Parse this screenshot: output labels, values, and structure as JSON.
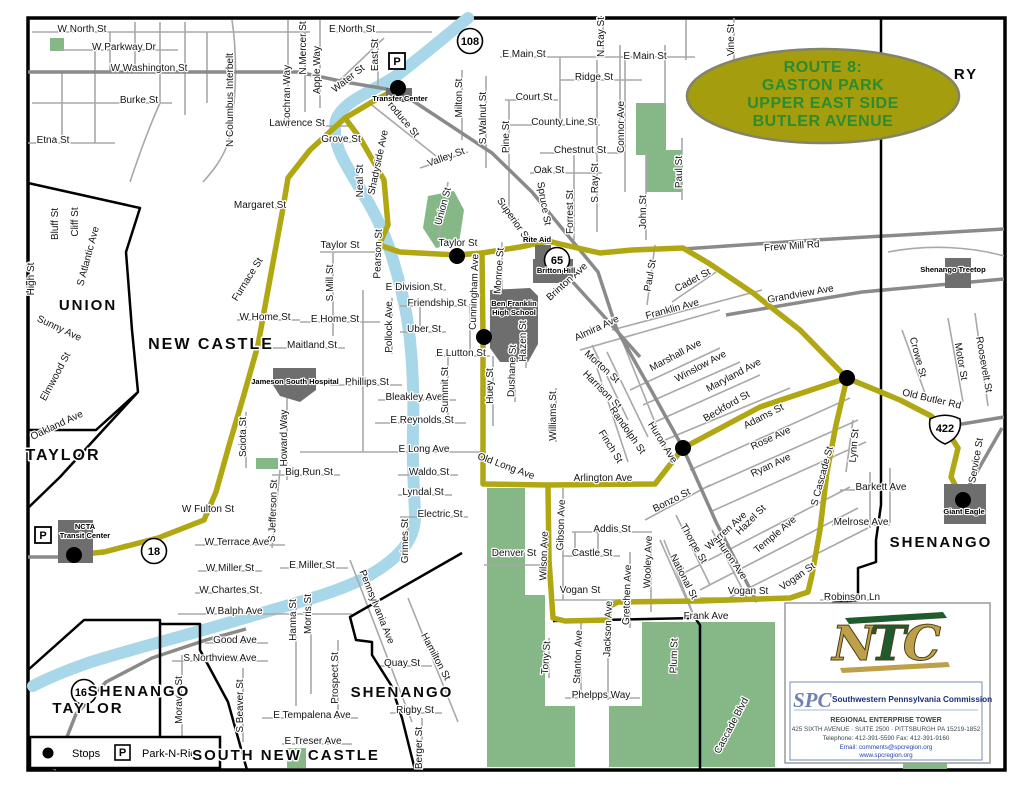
{
  "title_oval": {
    "lines": [
      "ROUTE 8:",
      "GASTON PARK",
      "UPPER EAST SIDE",
      "BUTLER AVENUE"
    ],
    "bg_color": "#a49d0e",
    "text_color": "#2e8b2e"
  },
  "legend": {
    "stops_label": "Stops",
    "park_symbol": "P",
    "park_n_ride_label": "Park-N-Ride"
  },
  "logo_box": {
    "ntc": "NTC",
    "spc": "SPC",
    "org": "Southwestern Pennsylvania Commission",
    "lines": [
      "REGIONAL ENTERPRISE TOWER",
      "425 SIXTH AVENUE · SUITE 2500 · PITTSBURGH PA 15219-1852",
      "Telephone:  412-391-5590        Fax:  412-391-9160",
      "Email: comments@spcregion.org",
      "www.spcregion.org"
    ]
  },
  "map": {
    "colors": {
      "route": "#b1a712",
      "river": "#a7d7e8",
      "park": "#86b786",
      "landmark": "#6e6e6e",
      "artery": "#8a8a8a",
      "street": "#a8a8a8",
      "boundary": "#000000"
    },
    "stops": [
      {
        "x": 398,
        "y": 88
      },
      {
        "x": 457,
        "y": 256
      },
      {
        "x": 484,
        "y": 337
      },
      {
        "x": 683,
        "y": 448
      },
      {
        "x": 847,
        "y": 378
      },
      {
        "x": 963,
        "y": 500
      },
      {
        "x": 74,
        "y": 555
      }
    ],
    "park_and_ride_icons": [
      {
        "x": 397,
        "y": 61
      },
      {
        "x": 43,
        "y": 535
      }
    ],
    "highway_shields": [
      {
        "n": "108",
        "x": 470,
        "y": 41,
        "type": "circle"
      },
      {
        "n": "65",
        "x": 557,
        "y": 260,
        "type": "circle"
      },
      {
        "n": "18",
        "x": 154,
        "y": 551,
        "type": "circle"
      },
      {
        "n": "168",
        "x": 84,
        "y": 692,
        "type": "circle"
      },
      {
        "n": "422",
        "x": 945,
        "y": 428,
        "type": "us"
      }
    ],
    "landmark_labels": [
      {
        "t": "Transfer Center",
        "x": 400,
        "y": 101
      },
      {
        "t": "Rite Aid",
        "x": 537,
        "y": 242
      },
      {
        "t": "Britton Hill",
        "x": 556,
        "y": 273
      },
      {
        "t": "Ben Franklin",
        "x": 514,
        "y": 306
      },
      {
        "t": "High School",
        "x": 514,
        "y": 315
      },
      {
        "t": "Jameson South Hospital",
        "x": 295,
        "y": 384
      },
      {
        "t": "NCTA",
        "x": 85,
        "y": 529
      },
      {
        "t": "Transit Center",
        "x": 85,
        "y": 538
      },
      {
        "t": "Shenango Treetop",
        "x": 953,
        "y": 272
      },
      {
        "t": "Giant Eagle",
        "x": 964,
        "y": 514
      }
    ],
    "area_labels": [
      {
        "t": "UNION",
        "x": 88,
        "y": 310,
        "fs": 15
      },
      {
        "t": "NEW CASTLE",
        "x": 211,
        "y": 349,
        "fs": 16
      },
      {
        "t": "TAYLOR",
        "x": 63,
        "y": 460,
        "fs": 16
      },
      {
        "t": "TAYLOR",
        "x": 88,
        "y": 713,
        "fs": 15
      },
      {
        "t": "SHENANGO",
        "x": 139,
        "y": 696,
        "fs": 15
      },
      {
        "t": "SHENANGO",
        "x": 402,
        "y": 697,
        "fs": 15
      },
      {
        "t": "SHENANGO",
        "x": 941,
        "y": 547,
        "fs": 15
      },
      {
        "t": "SOUTH NEW CASTLE",
        "x": 286,
        "y": 760,
        "fs": 15
      },
      {
        "t": "RY",
        "x": 966,
        "y": 79,
        "fs": 15
      }
    ],
    "street_labels": [
      {
        "t": "W North St",
        "x": 82,
        "y": 32
      },
      {
        "t": "W Parkway Dr",
        "x": 124,
        "y": 50
      },
      {
        "t": "W Washington St",
        "x": 149,
        "y": 71
      },
      {
        "t": "Burke St",
        "x": 139,
        "y": 103
      },
      {
        "t": "Etna St",
        "x": 53,
        "y": 143
      },
      {
        "t": "N Columbus Interbelt",
        "x": 233,
        "y": 100,
        "r": -90
      },
      {
        "t": "Cochran Way",
        "x": 290,
        "y": 95,
        "r": -90
      },
      {
        "t": "N Mercer St",
        "x": 306,
        "y": 48,
        "r": -90
      },
      {
        "t": "Apple Way",
        "x": 320,
        "y": 70,
        "r": -90
      },
      {
        "t": "E North St",
        "x": 352,
        "y": 32
      },
      {
        "t": "East St",
        "x": 378,
        "y": 55,
        "r": -90
      },
      {
        "t": "Water St",
        "x": 350,
        "y": 81,
        "r": -38
      },
      {
        "t": "Produce St",
        "x": 399,
        "y": 119,
        "r": 50
      },
      {
        "t": "Lawrence St",
        "x": 297,
        "y": 126
      },
      {
        "t": "Grove St",
        "x": 341,
        "y": 142
      },
      {
        "t": "Neal St",
        "x": 363,
        "y": 181,
        "r": -90
      },
      {
        "t": "Shadyside Ave",
        "x": 381,
        "y": 163,
        "r": -78
      },
      {
        "t": "Milton St",
        "x": 462,
        "y": 98,
        "r": -90
      },
      {
        "t": "S Walnut St",
        "x": 486,
        "y": 118,
        "r": -90
      },
      {
        "t": "Pine St",
        "x": 509,
        "y": 137,
        "r": -90
      },
      {
        "t": "Valley St",
        "x": 447,
        "y": 160,
        "r": -20
      },
      {
        "t": "Union St",
        "x": 446,
        "y": 207,
        "r": -75
      },
      {
        "t": "Superior St",
        "x": 511,
        "y": 221,
        "r": 55
      },
      {
        "t": "Spruce St",
        "x": 541,
        "y": 204,
        "r": 80
      },
      {
        "t": "Forrest St",
        "x": 573,
        "y": 212,
        "r": -90
      },
      {
        "t": "S Ray St",
        "x": 598,
        "y": 183,
        "r": -90
      },
      {
        "t": "John St",
        "x": 646,
        "y": 212,
        "r": -90
      },
      {
        "t": "Paul St",
        "x": 682,
        "y": 172,
        "r": -90
      },
      {
        "t": "Paul St",
        "x": 653,
        "y": 276,
        "r": -80
      },
      {
        "t": "Cadet St",
        "x": 694,
        "y": 283,
        "r": -28
      },
      {
        "t": "Frew Mill Rd",
        "x": 792,
        "y": 249,
        "r": -4
      },
      {
        "t": "Grandview Ave",
        "x": 801,
        "y": 297,
        "r": -10
      },
      {
        "t": "Crowe St",
        "x": 915,
        "y": 358,
        "r": 75
      },
      {
        "t": "Motor St",
        "x": 958,
        "y": 362,
        "r": 80
      },
      {
        "t": "Roosevelt St",
        "x": 981,
        "y": 365,
        "r": 80
      },
      {
        "t": "Old Butler Rd",
        "x": 931,
        "y": 402,
        "r": 13
      },
      {
        "t": "Service St",
        "x": 979,
        "y": 461,
        "r": -80
      },
      {
        "t": "E Main St",
        "x": 524,
        "y": 57
      },
      {
        "t": "E Main St",
        "x": 645,
        "y": 59
      },
      {
        "t": "Ridge St",
        "x": 594,
        "y": 80
      },
      {
        "t": "Court St",
        "x": 534,
        "y": 100
      },
      {
        "t": "County Line St",
        "x": 564,
        "y": 125
      },
      {
        "t": "Chestnut St",
        "x": 580,
        "y": 153
      },
      {
        "t": "Oak St",
        "x": 549,
        "y": 173
      },
      {
        "t": "N Ray St",
        "x": 604,
        "y": 37,
        "r": -90
      },
      {
        "t": "Vine St",
        "x": 734,
        "y": 40,
        "r": -90
      },
      {
        "t": "Connor Ave",
        "x": 624,
        "y": 127,
        "r": -90
      },
      {
        "t": "Margaret St",
        "x": 260,
        "y": 208
      },
      {
        "t": "Furnace St",
        "x": 250,
        "y": 281,
        "r": -58
      },
      {
        "t": "W Home St",
        "x": 265,
        "y": 320
      },
      {
        "t": "E Home St",
        "x": 335,
        "y": 322
      },
      {
        "t": "Maitland St",
        "x": 312,
        "y": 348
      },
      {
        "t": "Phillips St",
        "x": 367,
        "y": 385
      },
      {
        "t": "Bleakley Ave",
        "x": 414,
        "y": 400
      },
      {
        "t": "E Reynolds St",
        "x": 422,
        "y": 423
      },
      {
        "t": "E Long Ave",
        "x": 424,
        "y": 452
      },
      {
        "t": "Big Run St",
        "x": 309,
        "y": 475
      },
      {
        "t": "Waldo St",
        "x": 429,
        "y": 475
      },
      {
        "t": "Lyndal St",
        "x": 423,
        "y": 495
      },
      {
        "t": "Electric St",
        "x": 440,
        "y": 517
      },
      {
        "t": "Grimes St",
        "x": 408,
        "y": 541,
        "r": -90
      },
      {
        "t": "Sciota St",
        "x": 246,
        "y": 437,
        "r": -90
      },
      {
        "t": "Howard Way",
        "x": 287,
        "y": 438,
        "r": -90
      },
      {
        "t": "S Jefferson St",
        "x": 276,
        "y": 511,
        "r": -88
      },
      {
        "t": "Taylor St",
        "x": 340,
        "y": 248
      },
      {
        "t": "Taylor St",
        "x": 458,
        "y": 246
      },
      {
        "t": "Pearson St",
        "x": 381,
        "y": 254,
        "r": -88
      },
      {
        "t": "S Mill St",
        "x": 333,
        "y": 283,
        "r": -90
      },
      {
        "t": "Pollock Ave",
        "x": 392,
        "y": 327,
        "r": -90
      },
      {
        "t": "E Division St",
        "x": 414,
        "y": 290
      },
      {
        "t": "Friendship St",
        "x": 437,
        "y": 306
      },
      {
        "t": "Uber St",
        "x": 424,
        "y": 332
      },
      {
        "t": "E Lutton St",
        "x": 461,
        "y": 356
      },
      {
        "t": "Cunningham Ave",
        "x": 477,
        "y": 292,
        "r": -88
      },
      {
        "t": "Monroe St",
        "x": 502,
        "y": 271,
        "r": -86
      },
      {
        "t": "Hazen St",
        "x": 526,
        "y": 341,
        "r": -90
      },
      {
        "t": "Dushane St",
        "x": 515,
        "y": 371,
        "r": -88
      },
      {
        "t": "Huey St",
        "x": 493,
        "y": 386,
        "r": -90
      },
      {
        "t": "Williams St",
        "x": 556,
        "y": 416,
        "r": -90
      },
      {
        "t": "Summit St",
        "x": 448,
        "y": 390,
        "r": -90
      },
      {
        "t": "Brinton Ave",
        "x": 569,
        "y": 284,
        "r": -42
      },
      {
        "t": "Almira Ave",
        "x": 598,
        "y": 331,
        "r": -25
      },
      {
        "t": "Franklin Ave",
        "x": 673,
        "y": 312,
        "r": -15
      },
      {
        "t": "Morton St",
        "x": 600,
        "y": 369,
        "r": 42
      },
      {
        "t": "Harrison St",
        "x": 600,
        "y": 392,
        "r": 45
      },
      {
        "t": "Marshall Ave",
        "x": 677,
        "y": 358,
        "r": -28
      },
      {
        "t": "Winslow Ave",
        "x": 702,
        "y": 369,
        "r": -28
      },
      {
        "t": "Maryland Ave",
        "x": 735,
        "y": 378,
        "r": -28
      },
      {
        "t": "Beckford St",
        "x": 728,
        "y": 409,
        "r": -30
      },
      {
        "t": "Adams St",
        "x": 765,
        "y": 419,
        "r": -27
      },
      {
        "t": "Rose Ave",
        "x": 772,
        "y": 441,
        "r": -25
      },
      {
        "t": "Ryan Ave",
        "x": 772,
        "y": 468,
        "r": -25
      },
      {
        "t": "Randolph St",
        "x": 625,
        "y": 432,
        "r": 55
      },
      {
        "t": "Finch St",
        "x": 608,
        "y": 448,
        "r": 58
      },
      {
        "t": "Huron Ave",
        "x": 660,
        "y": 444,
        "r": 58
      },
      {
        "t": "Bonzo St",
        "x": 673,
        "y": 503,
        "r": -27
      },
      {
        "t": "Old Long Ave",
        "x": 505,
        "y": 469,
        "r": 20
      },
      {
        "t": "Arlington Ave",
        "x": 603,
        "y": 481
      },
      {
        "t": "Addis St",
        "x": 612,
        "y": 532
      },
      {
        "t": "Castle St",
        "x": 592,
        "y": 556
      },
      {
        "t": "Denver St",
        "x": 514,
        "y": 556
      },
      {
        "t": "Wilson Ave",
        "x": 547,
        "y": 556,
        "r": -88
      },
      {
        "t": "Gibson Ave",
        "x": 564,
        "y": 525,
        "r": -88
      },
      {
        "t": "Vogan St",
        "x": 580,
        "y": 593
      },
      {
        "t": "Vogan St",
        "x": 748,
        "y": 594
      },
      {
        "t": "Vogan St",
        "x": 799,
        "y": 579,
        "r": -35
      },
      {
        "t": "Gretchen Ave",
        "x": 630,
        "y": 595,
        "r": -88
      },
      {
        "t": "Wooley Ave",
        "x": 651,
        "y": 562,
        "r": -88
      },
      {
        "t": "National St",
        "x": 681,
        "y": 578,
        "r": 63
      },
      {
        "t": "Thorpe St",
        "x": 691,
        "y": 545,
        "r": 60
      },
      {
        "t": "Warren Ave",
        "x": 728,
        "y": 533,
        "r": -42
      },
      {
        "t": "Hazel St",
        "x": 753,
        "y": 522,
        "r": -45
      },
      {
        "t": "Temple Ave",
        "x": 777,
        "y": 537,
        "r": -40
      },
      {
        "t": "Huron Ave",
        "x": 729,
        "y": 561,
        "r": 55
      },
      {
        "t": "Jackson Ave",
        "x": 611,
        "y": 629,
        "r": -88
      },
      {
        "t": "Tony St",
        "x": 549,
        "y": 658,
        "r": -86
      },
      {
        "t": "Stanton Ave",
        "x": 581,
        "y": 657,
        "r": -88
      },
      {
        "t": "Plum St",
        "x": 677,
        "y": 656,
        "r": -88
      },
      {
        "t": "Phelpps Way",
        "x": 601,
        "y": 698
      },
      {
        "t": "Frank Ave",
        "x": 706,
        "y": 619
      },
      {
        "t": "Lynn St",
        "x": 857,
        "y": 446,
        "r": -85
      },
      {
        "t": "Barkett Ave",
        "x": 881,
        "y": 490
      },
      {
        "t": "Melrose Ave",
        "x": 861,
        "y": 525
      },
      {
        "t": "S Cascade St",
        "x": 825,
        "y": 477,
        "r": -75
      },
      {
        "t": "Robinson Ln",
        "x": 852,
        "y": 600
      },
      {
        "t": "Cascade Blvd",
        "x": 734,
        "y": 727,
        "r": -62
      },
      {
        "t": "W Fulton St",
        "x": 208,
        "y": 512
      },
      {
        "t": "W Terrace Ave",
        "x": 237,
        "y": 545
      },
      {
        "t": "W Miller St",
        "x": 230,
        "y": 571
      },
      {
        "t": "E Miller St",
        "x": 312,
        "y": 568
      },
      {
        "t": "W Chartes St",
        "x": 229,
        "y": 593
      },
      {
        "t": "W Balph Ave",
        "x": 234,
        "y": 614
      },
      {
        "t": "Good Ave",
        "x": 235,
        "y": 643
      },
      {
        "t": "S Northview Ave",
        "x": 220,
        "y": 661
      },
      {
        "t": "Moravia St",
        "x": 182,
        "y": 700,
        "r": -90
      },
      {
        "t": "Hanna St",
        "x": 296,
        "y": 620,
        "r": -90
      },
      {
        "t": "Morris St",
        "x": 311,
        "y": 614,
        "r": -90
      },
      {
        "t": "Prospect St",
        "x": 338,
        "y": 678,
        "r": -90
      },
      {
        "t": "S Beaver St",
        "x": 243,
        "y": 706,
        "r": -90
      },
      {
        "t": "E Tempalena Ave",
        "x": 312,
        "y": 718
      },
      {
        "t": "E Treser Ave",
        "x": 313,
        "y": 744
      },
      {
        "t": "Quay St",
        "x": 402,
        "y": 666
      },
      {
        "t": "Rigby St",
        "x": 415,
        "y": 713
      },
      {
        "t": "Berger St",
        "x": 422,
        "y": 748,
        "r": -90
      },
      {
        "t": "Pennsylvania Ave",
        "x": 374,
        "y": 608,
        "r": 68
      },
      {
        "t": "Hamilton St",
        "x": 433,
        "y": 658,
        "r": 62
      },
      {
        "t": "Bluff St",
        "x": 58,
        "y": 224,
        "r": -90
      },
      {
        "t": "Cliff St",
        "x": 78,
        "y": 222,
        "r": -90
      },
      {
        "t": "S Atlantic Ave",
        "x": 91,
        "y": 257,
        "r": -75
      },
      {
        "t": "High St",
        "x": 34,
        "y": 279,
        "r": -90
      },
      {
        "t": "Sunny Ave",
        "x": 58,
        "y": 331,
        "r": 25
      },
      {
        "t": "Elmwood St",
        "x": 58,
        "y": 378,
        "r": -62
      },
      {
        "t": "Oakland Ave",
        "x": 58,
        "y": 428,
        "r": -25
      }
    ]
  }
}
